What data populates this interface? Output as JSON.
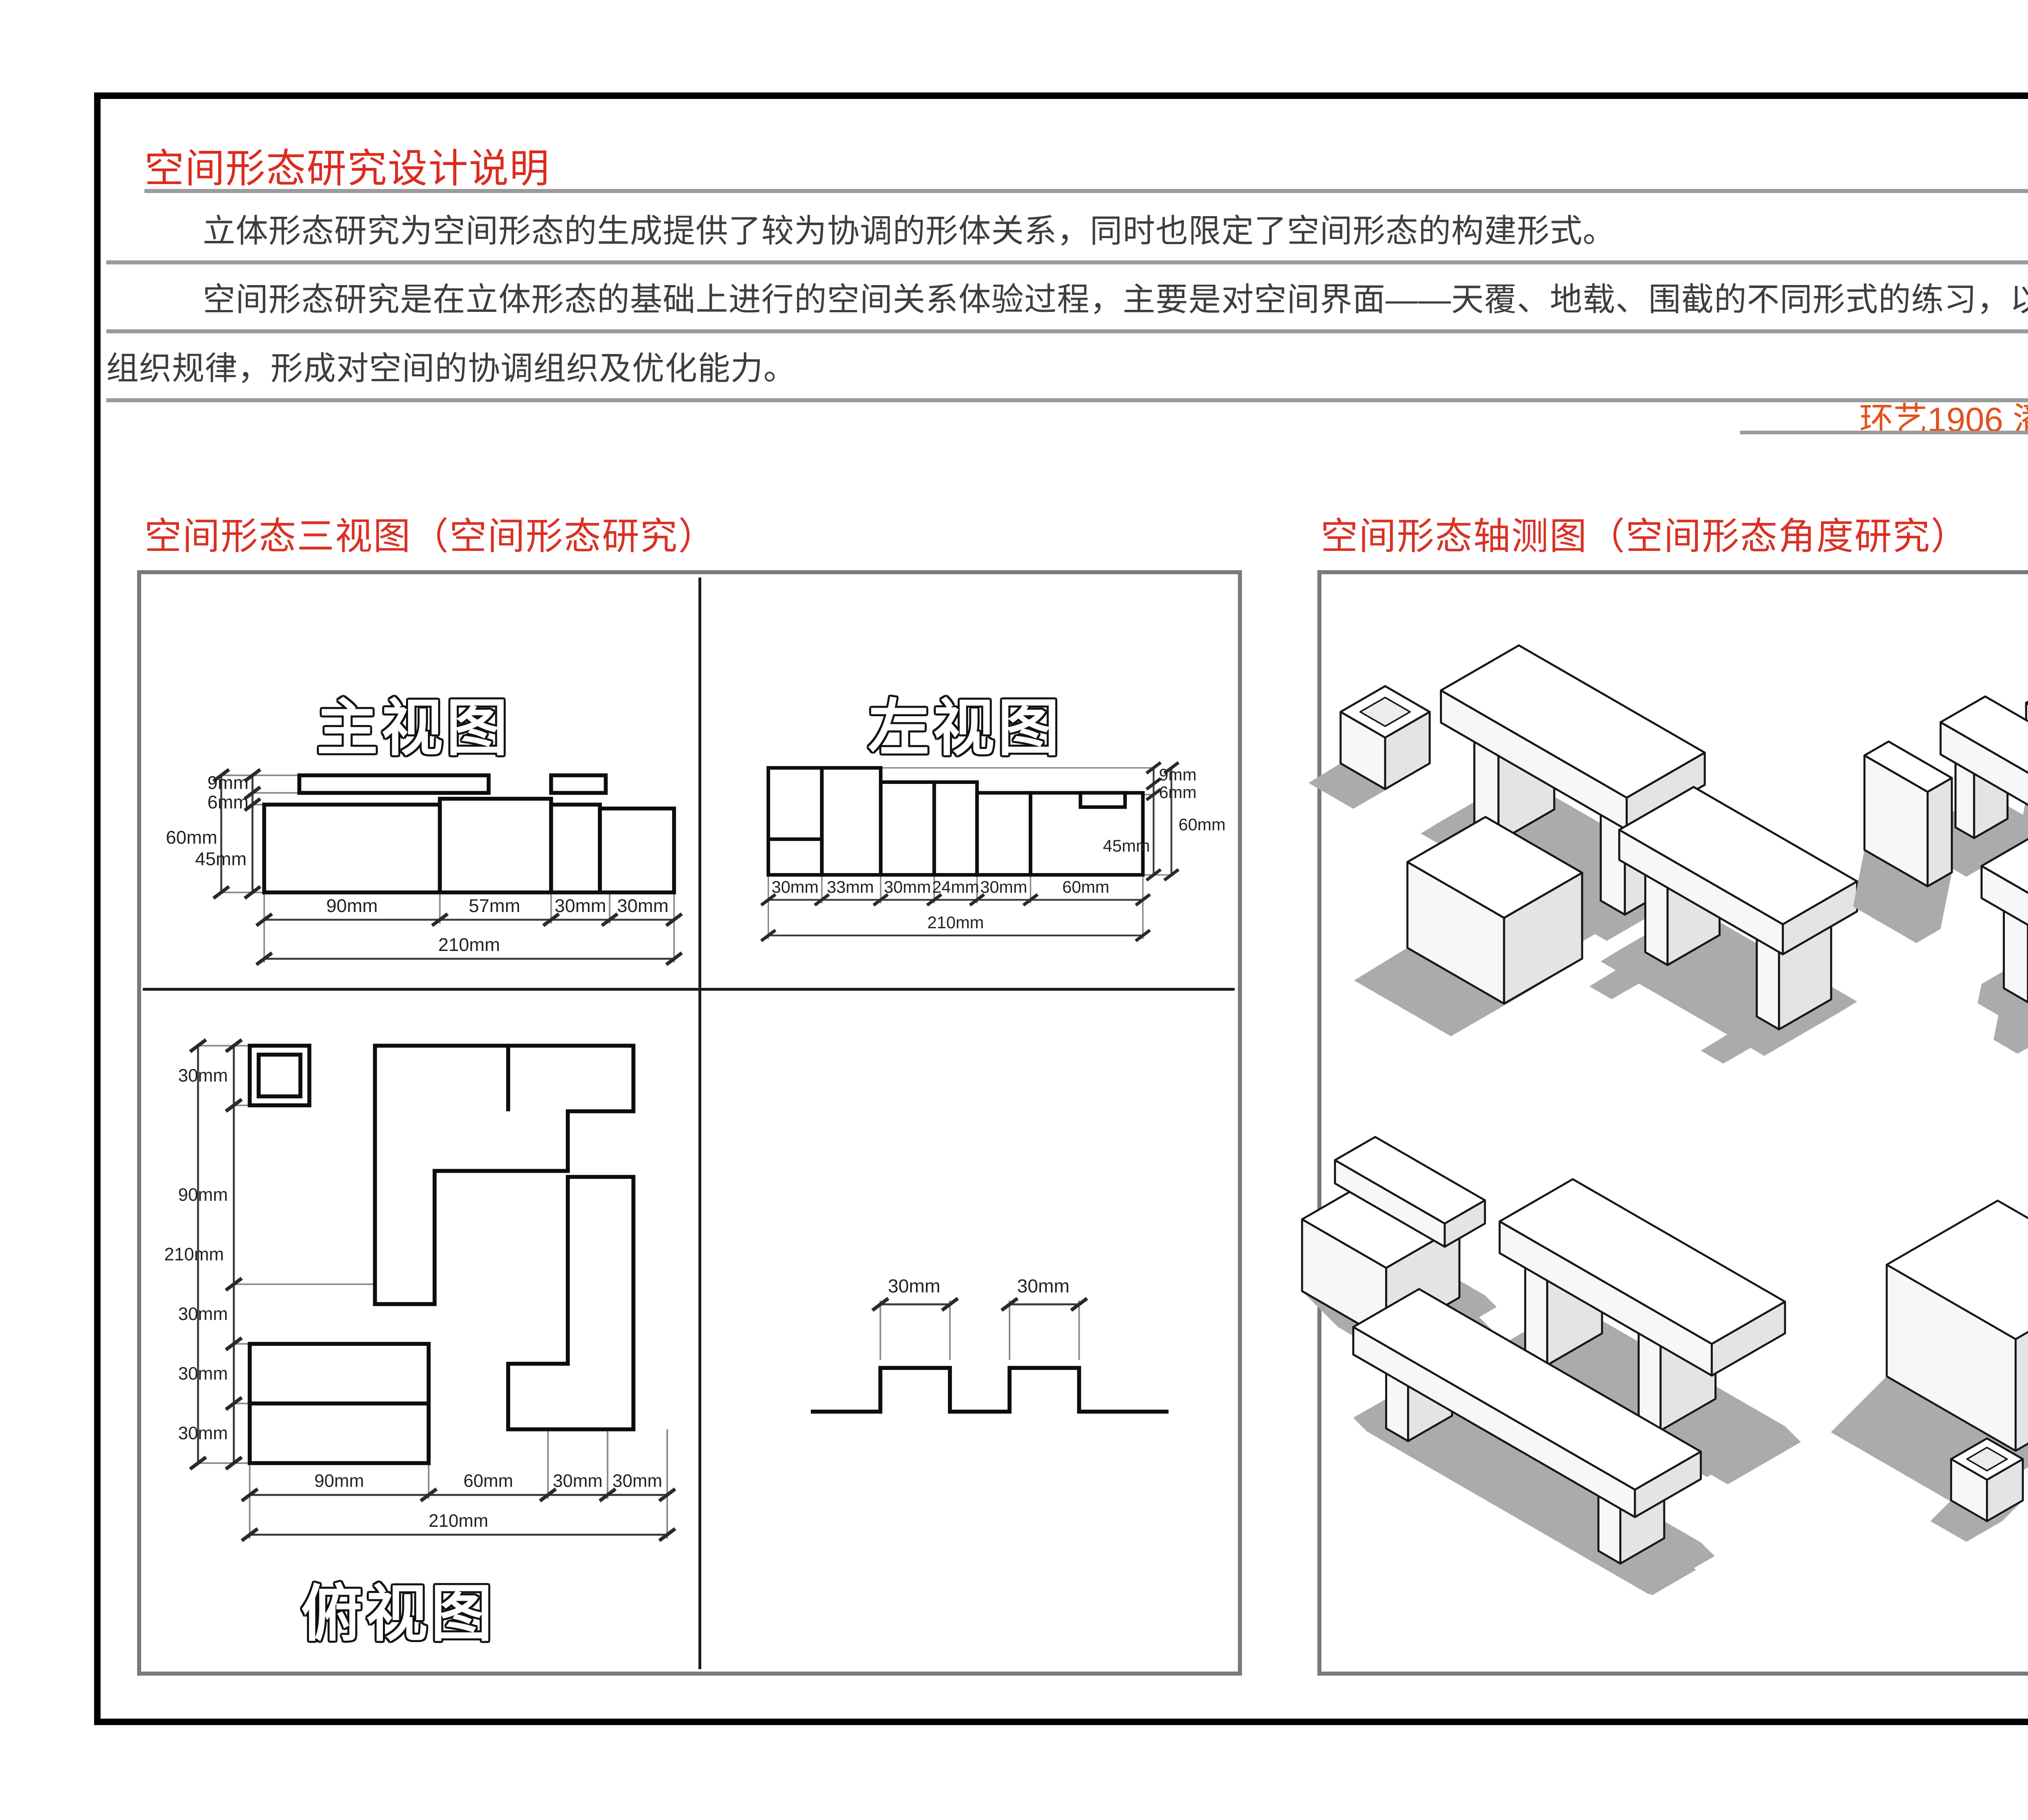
{
  "sheet": {
    "title": "空间形态研究设计说明",
    "paragraphs": [
      "立体形态研究为空间形态的生成提供了较为协调的形体关系，同时也限定了空间形态的构建形式。",
      "空间形态研究是在立体形态的基础上进行的空间关系体验过程，主要是对空间界面——天覆、地载、围截的不同形式的练习，以积累不同的空间构建形式及其",
      "组织规律，形成对空间的协调组织及优化能力。"
    ],
    "student_info": "环艺1906  潘雅轩   201940283",
    "section_left": "空间形态三视图（空间形态研究）",
    "section_right": "空间形态轴测图（空间形态角度研究）"
  },
  "views": {
    "front": {
      "title": "主视图",
      "left_dims": [
        "9mm",
        "6mm",
        "60mm",
        "45mm"
      ],
      "bottom_dims": [
        "90mm",
        "57mm",
        "30mm",
        "30mm"
      ],
      "total": "210mm"
    },
    "left": {
      "title": "左视图",
      "right_dims": [
        "9mm",
        "6mm",
        "60mm",
        "45mm"
      ],
      "bottom_dims": [
        "30mm",
        "33mm",
        "30mm",
        "24mm",
        "30mm",
        "60mm"
      ],
      "total": "210mm"
    },
    "top": {
      "title": "俯视图",
      "left_dims": [
        "30mm",
        "90mm",
        "30mm",
        "30mm",
        "30mm"
      ],
      "left_total": "210mm",
      "bottom_dims": [
        "90mm",
        "60mm",
        "30mm",
        "30mm"
      ],
      "bottom_total": "210mm"
    },
    "profile": {
      "dims": [
        "30mm",
        "30mm"
      ]
    }
  },
  "colors": {
    "accent_red": "#d93125",
    "title_red": "#dc2b1f",
    "student_info_orange": "#e2511c",
    "rule_gray": "#9b9b9b",
    "panel_border_gray": "#7a7a7a",
    "shadow_gray": "#ababab"
  }
}
